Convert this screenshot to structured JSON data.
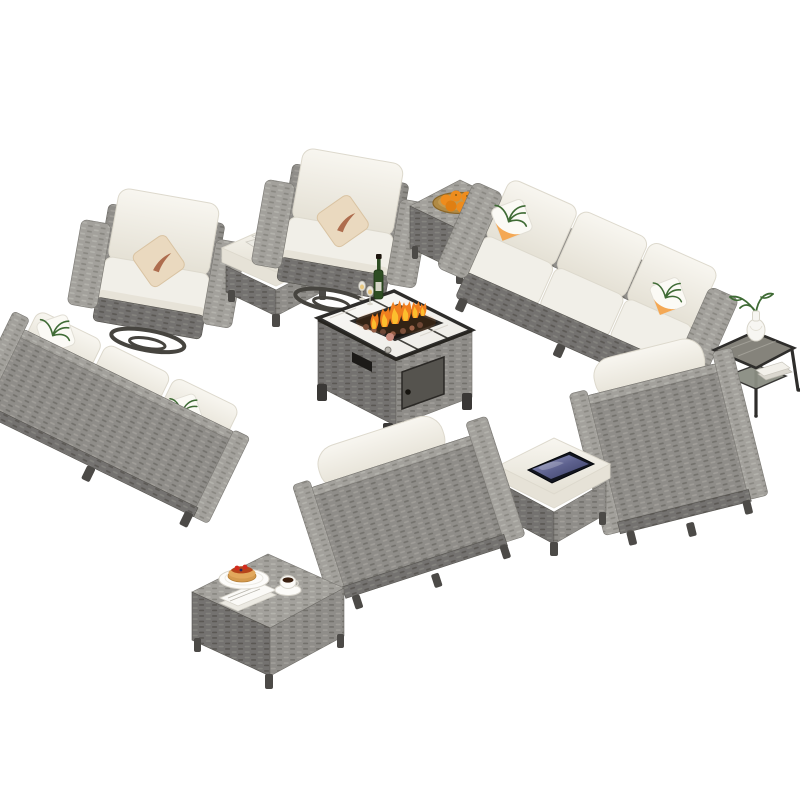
{
  "scene": {
    "title": "Outdoor Patio Wicker Furniture Conversation Set",
    "description": "13-piece gray rattan wicker outdoor patio conversation set with beige cushions arranged in a rectangle around a rectangular fire pit table with marble top and burning flame, photographed on a plain white background",
    "background": "#ffffff",
    "canvas": {
      "width": 800,
      "height": 800
    },
    "colors": {
      "background": "#ffffff",
      "wicker": "#8f8d89",
      "wicker-light": "#a9a7a2",
      "wicker-dark": "#7b7975",
      "wicker-darker": "#615f5b",
      "cushion": "#f1efe8",
      "cushion-shade": "#ddd9cd",
      "pillow-beige": "#ead9bf",
      "pillow-orange": "#f3a34b",
      "palm-green": "#3f6b35",
      "marble-white": "#f7f5f1",
      "frame-black": "#2e2d2b",
      "flame-orange": "#f07f1f",
      "flame-yellow": "#fcc22f",
      "fruit-orange": "#ee8c1d",
      "lava-rock": "#8a5a4a",
      "tablet-screen": "#7d81ad",
      "metal-gray": "#46443f",
      "coffee-brown": "#3a2010",
      "syrup-red": "#b5441a",
      "pancake-tan": "#e2a85c",
      "bottle-green": "#2e4d23",
      "glass-top": "#85837b"
    },
    "items": [
      {
        "id": "swivel-chair-left",
        "label": "Swivel club chair with beige leaf-print throw pillow",
        "accessories": [
          "beige throw pillow",
          "swivel base"
        ]
      },
      {
        "id": "ottoman-magazines",
        "label": "Wicker ottoman with cushion and magazines on top",
        "accessories": [
          "magazines"
        ]
      },
      {
        "id": "swivel-chair-right",
        "label": "Swivel club chair with beige leaf-print throw pillow",
        "accessories": [
          "beige throw pillow",
          "swivel base"
        ]
      },
      {
        "id": "side-table-oranges",
        "label": "Square wicker side table with tray of oranges",
        "accessories": [
          "tray of oranges"
        ]
      },
      {
        "id": "sofa-top-right",
        "label": "Three-seat wicker sofa with palm-print pillows",
        "accessories": [
          "palm-print pillow left",
          "palm-print pillow right"
        ]
      },
      {
        "id": "end-table-vase",
        "label": "End table with white vase, greenery and books on lower shelf",
        "accessories": [
          "white vase",
          "green plant",
          "books"
        ]
      },
      {
        "id": "sofa-left",
        "label": "Three-seat wicker sofa seen from behind with palm-print pillows",
        "accessories": [
          "palm-print pillow left",
          "palm-print pillow right"
        ]
      },
      {
        "id": "fire-pit-table",
        "label": "Rectangular fire pit table with marble top, burning flame, lava rocks, wine bottle and glasses",
        "accessories": [
          "wine bottle",
          "two glasses",
          "flame",
          "lava rocks",
          "access door",
          "vent"
        ]
      },
      {
        "id": "chair-bottom-right",
        "label": "Club chair seen from behind with white bolster pillow"
      },
      {
        "id": "ottoman-tablet",
        "label": "Wicker ottoman with cushion and tablet on top",
        "accessories": [
          "tablet"
        ]
      },
      {
        "id": "chair-bottom-left",
        "label": "Club chair seen from behind with white bolster pillow"
      },
      {
        "id": "coffee-table-breakfast",
        "label": "Square wicker coffee table with pancakes, coffee cup and napkins",
        "accessories": [
          "plate of pancakes",
          "coffee cup and saucer",
          "napkins"
        ]
      }
    ]
  }
}
